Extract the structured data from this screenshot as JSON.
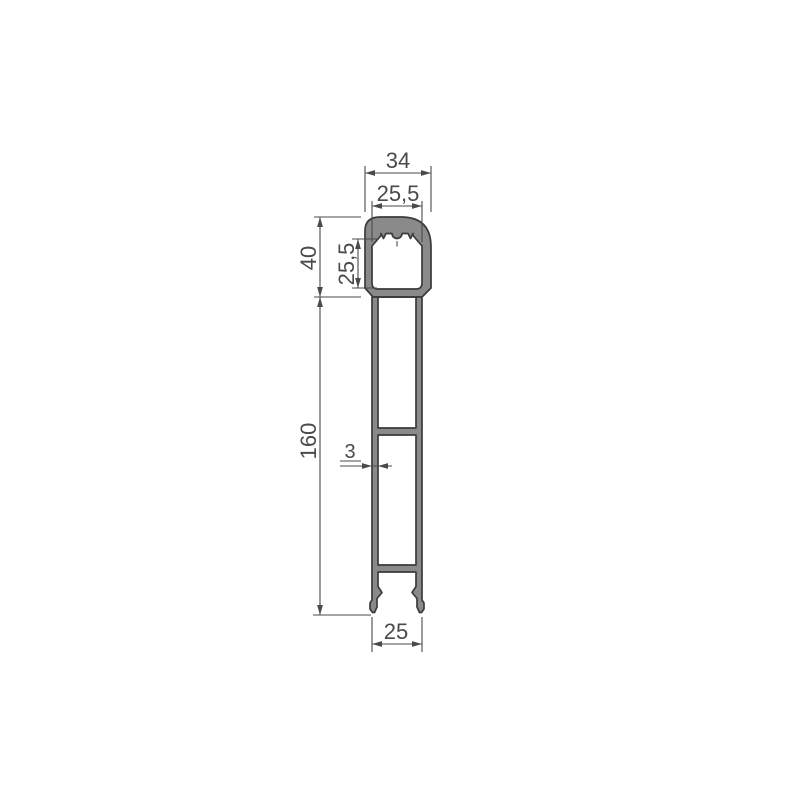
{
  "drawing": {
    "colors": {
      "background": "#ffffff",
      "profile_fill": "#8a8a8a",
      "outline": "#3b3b3b",
      "dimension": "#4a4a4a"
    },
    "dimensions": {
      "head_outer_width": "34",
      "head_inner_width": "25,5",
      "head_outer_height": "40",
      "head_inner_height": "25,5",
      "body_height": "160",
      "wall_thickness": "3",
      "bottom_width": "25"
    }
  }
}
